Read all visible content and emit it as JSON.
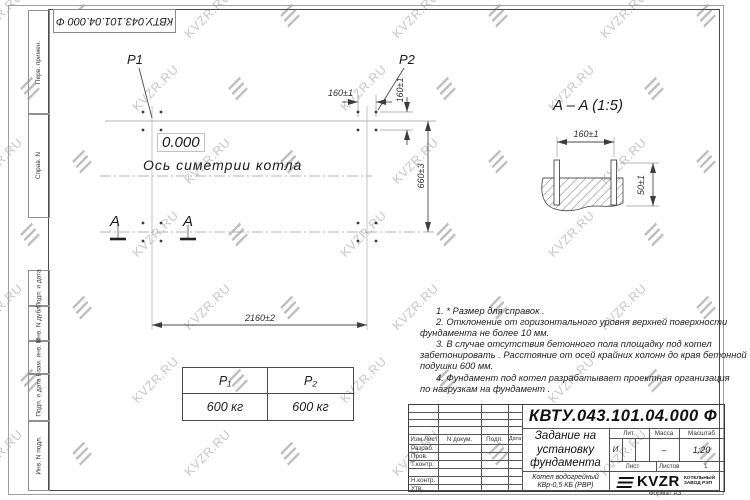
{
  "stamp_top": "КВТУ.043.101.04.000 Ф",
  "watermark": {
    "text": "KVZR.RU"
  },
  "sidebar": {
    "items": [
      {
        "label": "Перв. примен."
      },
      {
        "label": "Справ. N"
      },
      {
        "label": "Подп. и дата"
      },
      {
        "label": "Инв. N дубл."
      },
      {
        "label": "Взам. инв. N"
      },
      {
        "label": "Подп. и дата"
      },
      {
        "label": "Инв. N подл."
      }
    ]
  },
  "plan": {
    "p1_label": "P1",
    "p2_label": "P2",
    "level_mark": "0.000",
    "axis_label": "Ось симетрии котла",
    "dim_160_h": "160±1",
    "dim_160_v": "160±1",
    "dim_660": "660±3",
    "dim_2160": "2160±2",
    "section_letter": "A"
  },
  "section": {
    "title": "A – A (1:5)",
    "dim_160": "160±1",
    "dim_50": "50±1"
  },
  "notes": {
    "lines": [
      "1. * Размер для справок .",
      "2. Отклонение от горизонтального уровня верхней поверхности",
      "фундамента не более  10  мм.",
      "3. В случае отсутствия бетонного пола площадку под котел",
      "забетонировать . Расстояние от осей крайних колонн до края бетонной",
      "подушки  600  мм.",
      "4. Фундамент под котел разрабатывает проектная организация",
      "по нагрузкам на фундамент ."
    ]
  },
  "load_table": {
    "headers": [
      "P₁",
      "P₂"
    ],
    "values": [
      "600 кг",
      "600 кг"
    ]
  },
  "title_block": {
    "designation": "КВТУ.043.101.04.000  Ф",
    "doc_title_lines": [
      "Задание на",
      "установку",
      "фундамента"
    ],
    "product_lines": [
      "Котел водогрейный",
      "КВр-0,5  КБ  (РВР)"
    ],
    "header_cols": [
      "Изм.Лист",
      "N докум.",
      "Подп.",
      "Дата"
    ],
    "rows": [
      "Разраб.",
      "Пров.",
      "Т.контр.",
      "",
      "Н.контр.",
      "Утв."
    ],
    "lit_label": "Лит.",
    "mass_label": "Масса",
    "scale_label": "Масштаб",
    "lit_value": "И",
    "mass_value": "–",
    "scale_value": "1:20",
    "sheet_label": "Лист",
    "sheets_label": "Листов",
    "sheets_value": "1",
    "logo_text": "KVZR",
    "logo_caption_lines": [
      "КОТЕЛЬНЫЙ",
      "ЗАВОД РЭП"
    ],
    "format_label": "Формат А3"
  }
}
